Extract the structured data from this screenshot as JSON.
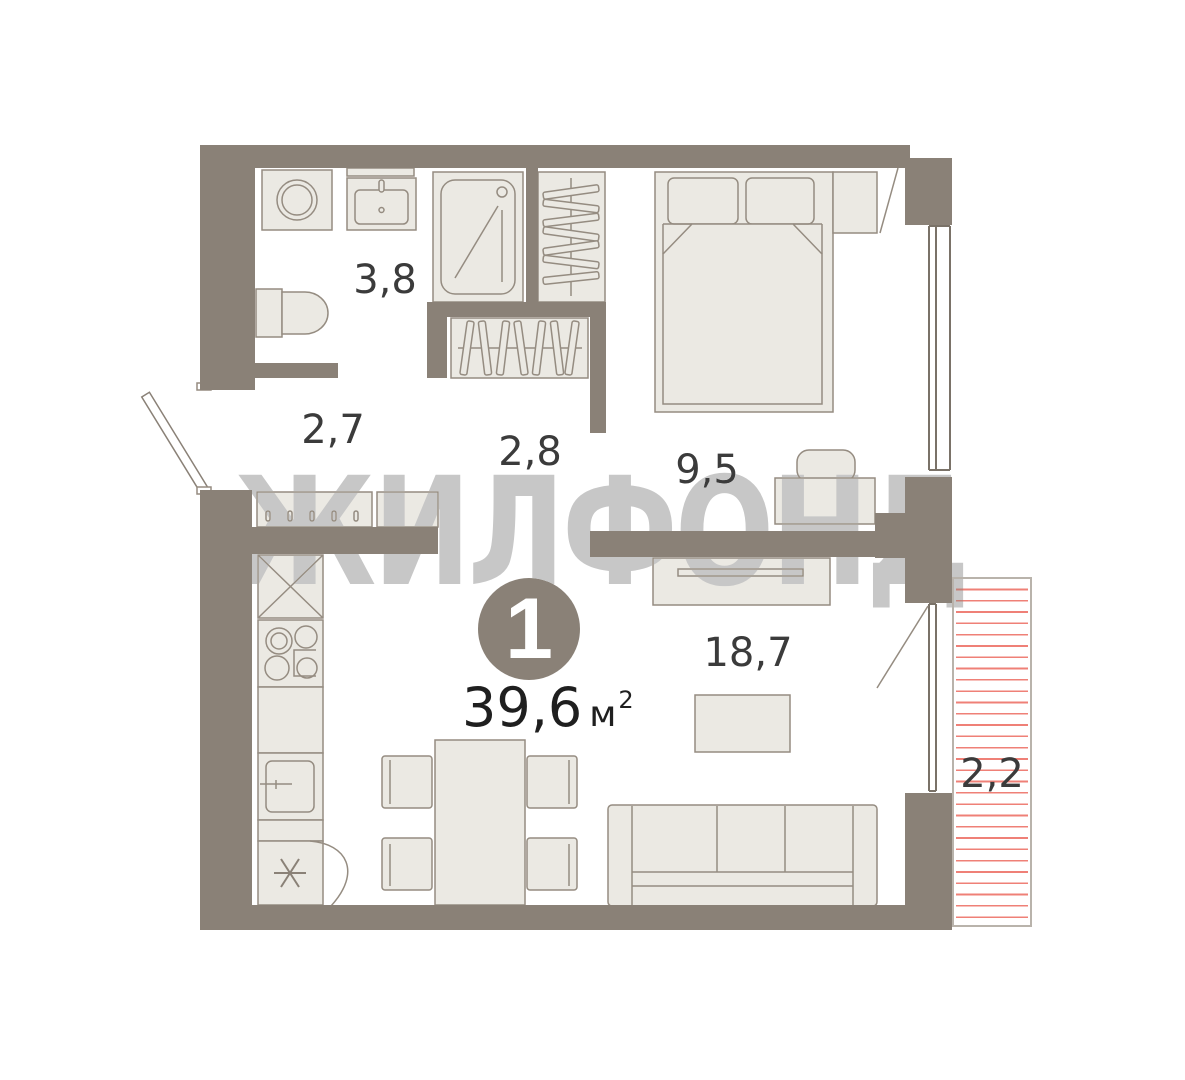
{
  "watermark": "ЖИЛФОНД",
  "badge": {
    "rooms_count": "1"
  },
  "total_area": {
    "value": "39,6",
    "unit": "м",
    "superscript": "2"
  },
  "rooms": {
    "bathroom": "3,8",
    "hallway": "2,7",
    "corridor": "2,8",
    "bedroom": "9,5",
    "living_kitchen": "18,7",
    "balcony": "2,2"
  },
  "colors": {
    "wall": "#8a8177",
    "furniture_fill": "#ebe9e3",
    "furniture_stroke": "#958c81",
    "balcony_hatch": "#ef8077",
    "label_text": "#3b3b3b",
    "watermark_gray": "#c7c7c7",
    "background": "#ffffff"
  },
  "furniture": [
    "washing-machine",
    "bathroom-sink",
    "toilet",
    "shower",
    "wardrobe-side",
    "wardrobe-front",
    "coat-rack",
    "hall-cabinet",
    "entrance-door",
    "kitchen-tall-cabinet",
    "stove",
    "kitchen-counter",
    "kitchen-sink",
    "fridge",
    "dining-table",
    "dining-chair",
    "sofa",
    "dresser",
    "coffee-table",
    "bed",
    "pillow",
    "blanket",
    "nightstand",
    "desk",
    "desk-chair",
    "window",
    "balcony-door"
  ]
}
